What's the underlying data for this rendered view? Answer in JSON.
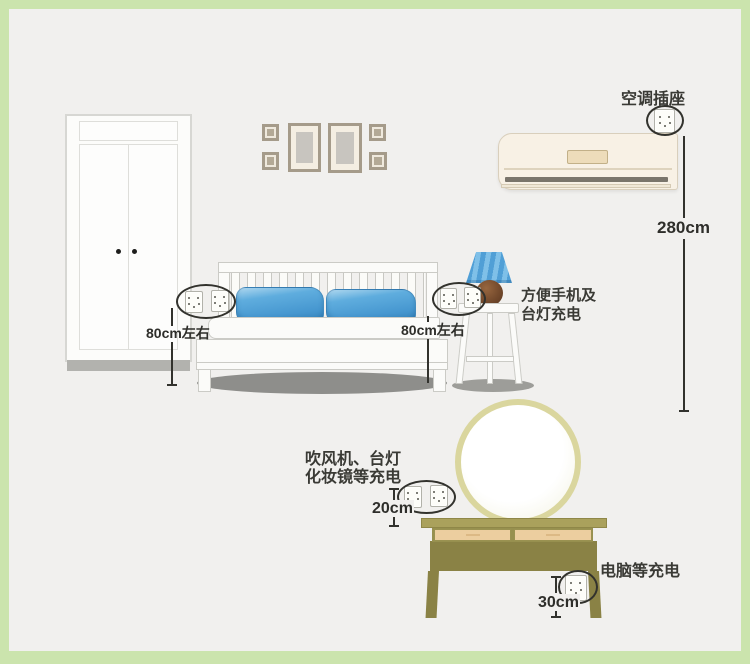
{
  "labels": {
    "ac_socket": "空调插座",
    "nightstand_line1": "方便手机及",
    "nightstand_line2": "台灯充电",
    "vanity_line1": "吹风机、台灯",
    "vanity_line2": "化妆镜等充电",
    "desk": "电脑等充电"
  },
  "measurements": {
    "wardrobe_side": "80cm左右",
    "bed_side": "80cm左右",
    "ac": "280cm",
    "vanity": "20cm",
    "desk": "30cm"
  },
  "colors": {
    "frame_green": "#cbe4ad",
    "wall": "#f1f0ee",
    "pillow_blue": "#4a9ed6",
    "lamp_shade_blue": "#58a8de",
    "lamp_base_brown": "#744a2c",
    "ac_cream": "#f8f1e5",
    "mirror_ring": "#dad69e",
    "table_olive": "#8a8245",
    "drawer_tan": "#ecce9f",
    "annotation_ink": "#32322d"
  },
  "icons": {
    "socket": "power-socket",
    "circle": "hand-drawn-ellipse-highlight"
  }
}
